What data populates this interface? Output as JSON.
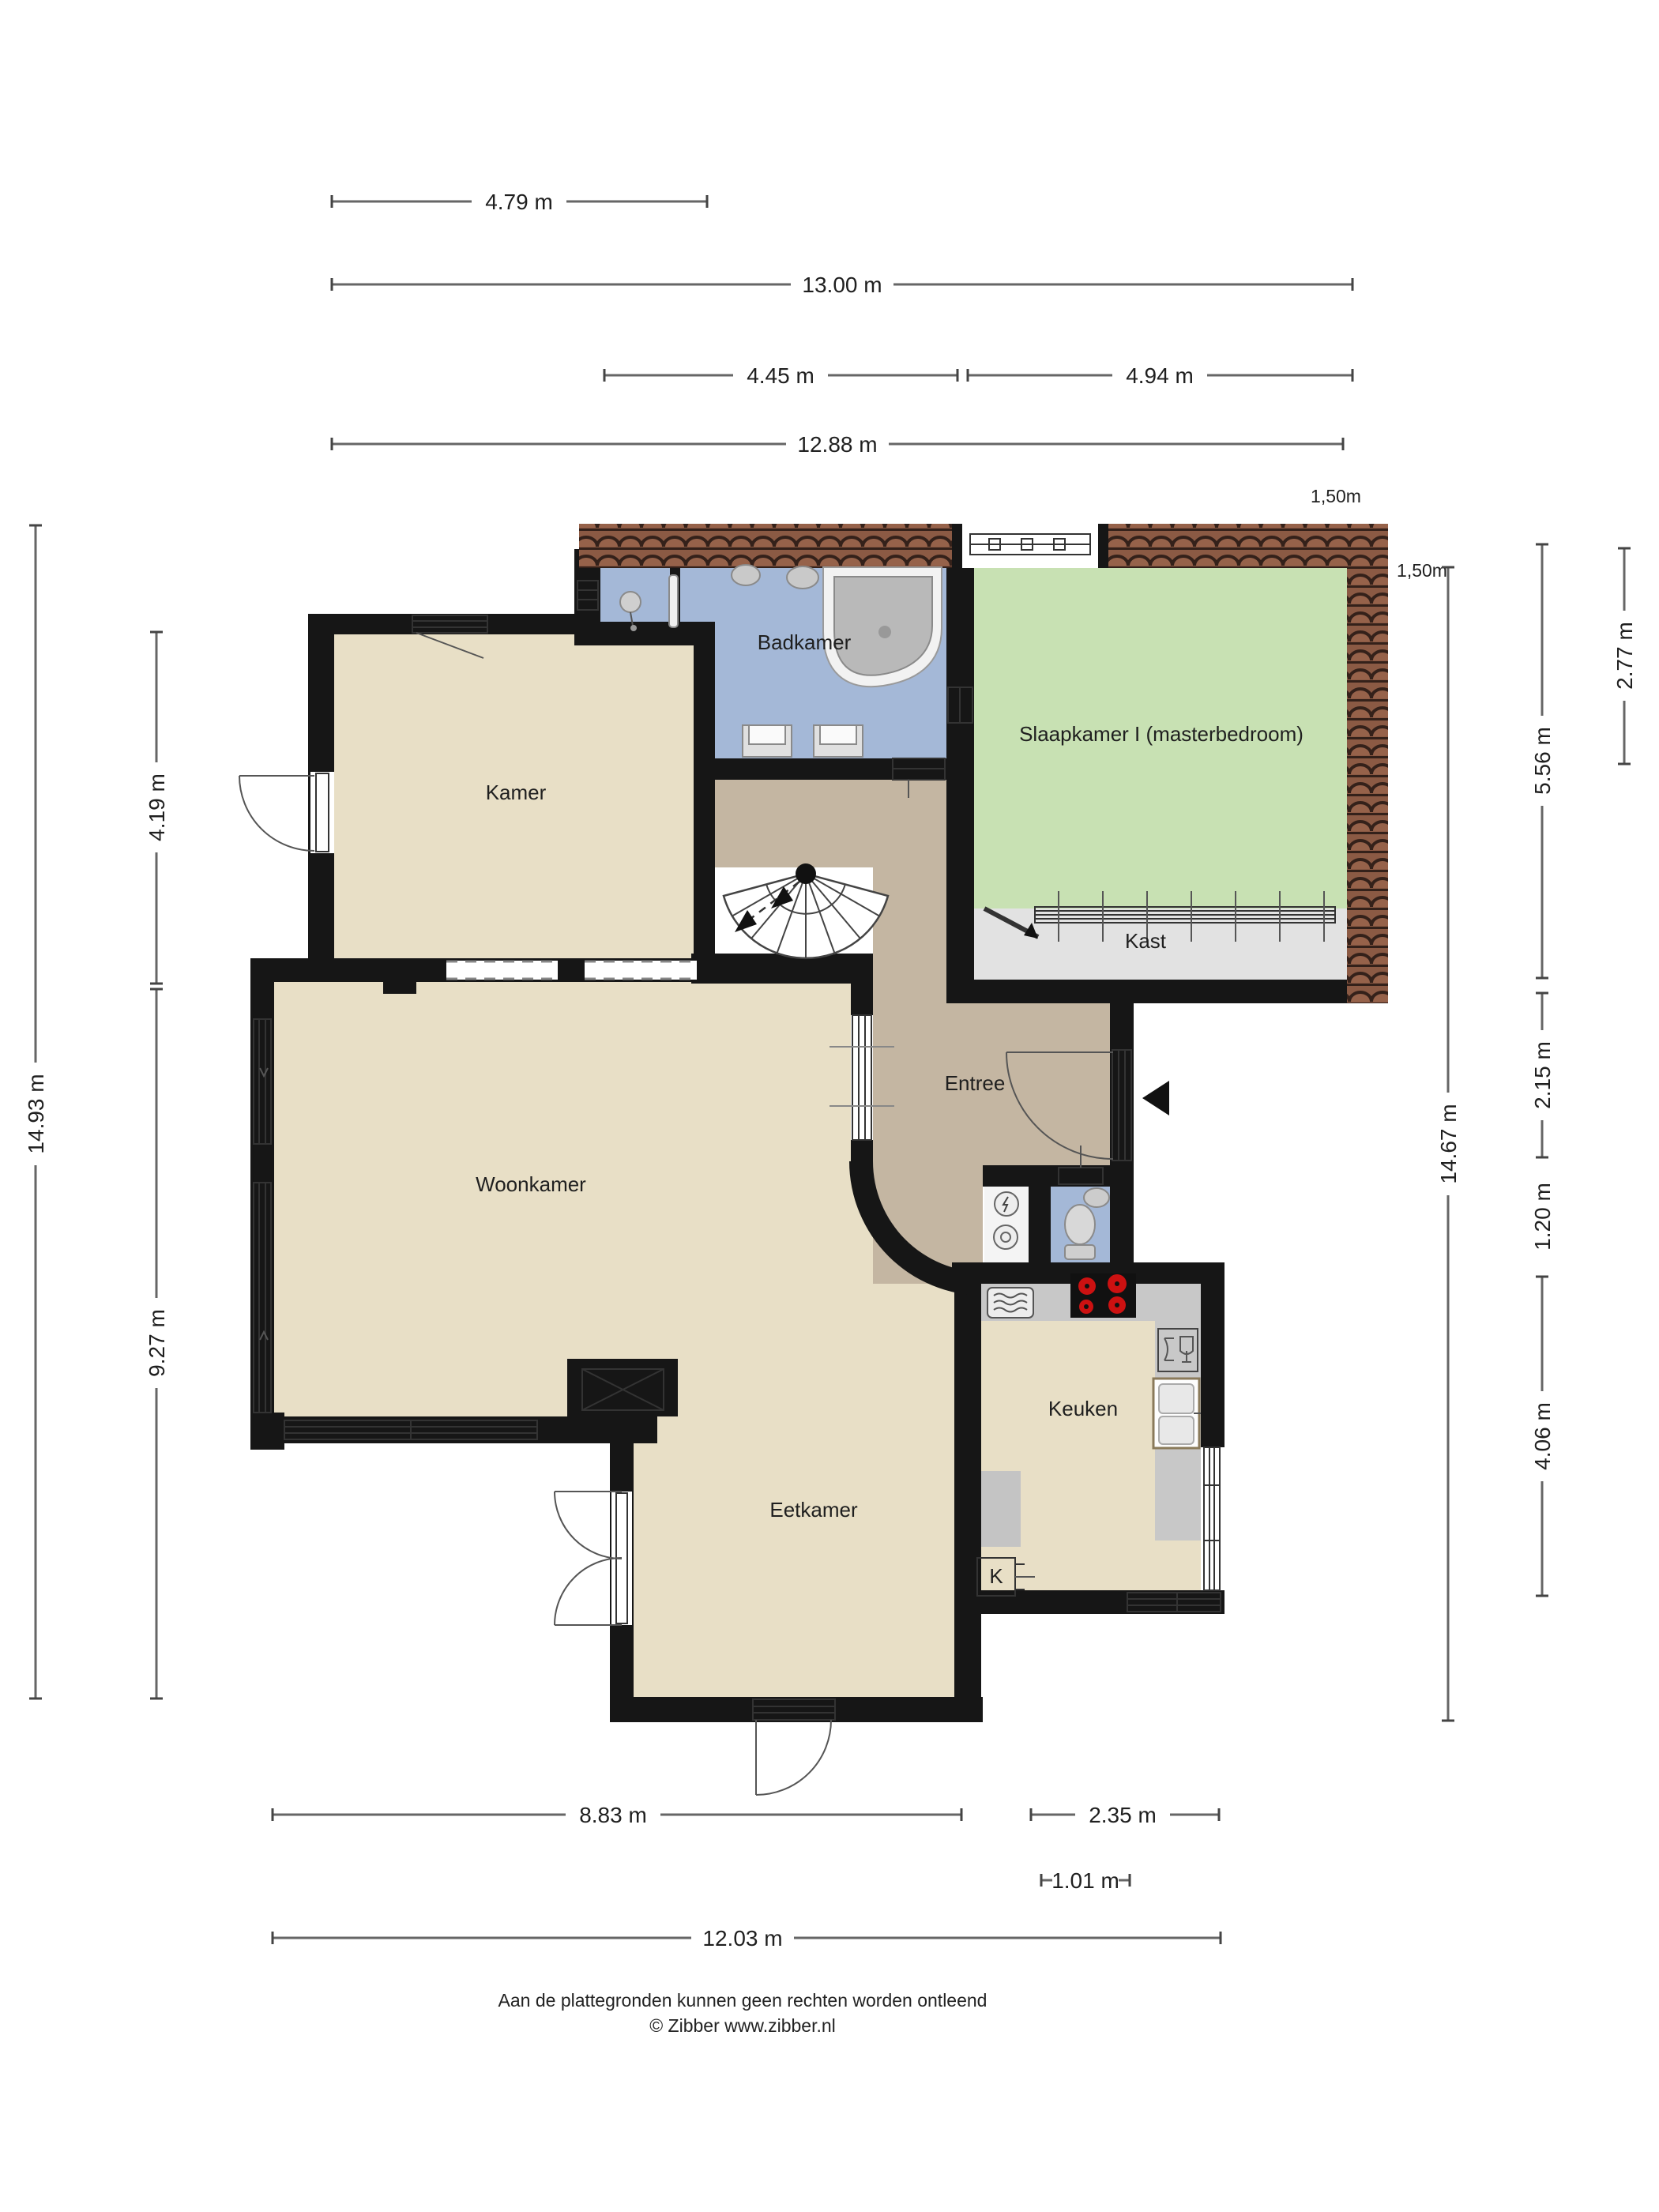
{
  "rooms": {
    "badkamer": "Badkamer",
    "slaapkamer": "Slaapkamer I (masterbedroom)",
    "kast": "Kast",
    "kamer": "Kamer",
    "woonkamer": "Woonkamer",
    "entree": "Entree",
    "keuken": "Keuken",
    "eetkamer": "Eetkamer",
    "k": "K"
  },
  "dims": {
    "t1": "4.79 m",
    "t2": "13.00 m",
    "t3": "4.45 m",
    "t4": "4.94 m",
    "t5": "12.88 m",
    "r150a": "1,50m",
    "r150b": "1,50m",
    "l1493": "14.93 m",
    "l419": "4.19 m",
    "l927": "9.27 m",
    "r277": "2.77 m",
    "r556": "5.56 m",
    "r215": "2.15 m",
    "r120": "1.20 m",
    "r406": "4.06 m",
    "r1467": "14.67 m",
    "b883": "8.83 m",
    "b235": "2.35 m",
    "b101": "1.01 m",
    "b1203": "12.03 m"
  },
  "footer": {
    "line1": "Aan de plattegronden kunnen geen rechten worden ontleend",
    "line2": "© Zibber www.zibber.nl"
  },
  "colors": {
    "room": "#e8dfc6",
    "hall": "#c4b6a2",
    "bathroom": "#a4b8d7",
    "bedroom": "#c8e1b3",
    "closet": "#e2e2e2",
    "wall": "#161616",
    "roofBase": "#8b5a44",
    "roofDark": "#34211a",
    "counter": "#c8c8c8",
    "burner": "#cc1111"
  }
}
